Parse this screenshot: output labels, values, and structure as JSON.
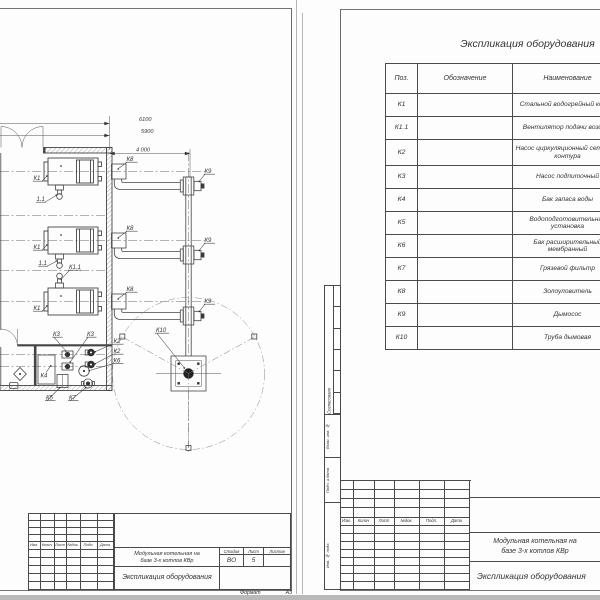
{
  "left_sheet": {
    "dimensions": {
      "top1": "6100",
      "top2": "5900",
      "right": "4 000"
    },
    "plan_labels": {
      "k1": "К1",
      "k1_1_short": "1.1",
      "k1_1": "К1.1",
      "k2": "К2",
      "k3": "К3",
      "k4": "К4",
      "k5": "К5",
      "k6": "К6",
      "k7": "К7",
      "k8": "К8",
      "k9": "К9",
      "k10": "К10"
    },
    "title_block": {
      "cols": [
        "Изм.",
        "Колич",
        "Лист",
        "№док.",
        "Подп.",
        "Дата"
      ],
      "project_line1": "Модульная котельная на",
      "project_line2": "базе 3-х котлов КВр",
      "doc_title": "Экспликация оборудования",
      "stage_label": "Стадия",
      "sheet_label": "Лист",
      "sheets_label": "Листов",
      "stage": "ВО",
      "sheet_num": "5",
      "format_label": "Формат",
      "format_value": "А3"
    }
  },
  "right_sheet": {
    "table_title": "Экспликация оборудования",
    "table": {
      "headers": {
        "pos": "Поз.",
        "designation": "Обозначение",
        "name": "Наименование"
      },
      "rows": [
        {
          "pos": "К1",
          "designation": "",
          "name": "Стальной водогрейный котел"
        },
        {
          "pos": "К1.1",
          "designation": "",
          "name": "Вентилятор подачи воздуха"
        },
        {
          "pos": "К2",
          "designation": "",
          "name": "Насос циркуляционный сетевого контура"
        },
        {
          "pos": "К3",
          "designation": "",
          "name": "Насос подпиточный"
        },
        {
          "pos": "К4",
          "designation": "",
          "name": "Бак запаса воды"
        },
        {
          "pos": "К5",
          "designation": "",
          "name": "Водоподготовительная установка"
        },
        {
          "pos": "К6",
          "designation": "",
          "name": "Бак расширительный мембранный"
        },
        {
          "pos": "К7",
          "designation": "",
          "name": "Грязевой фильтр"
        },
        {
          "pos": "К8",
          "designation": "",
          "name": "Золоуловитель"
        },
        {
          "pos": "К9",
          "designation": "",
          "name": "Дымосос"
        },
        {
          "pos": "К10",
          "designation": "",
          "name": "Труба дымовая"
        }
      ]
    },
    "side_strip": {
      "agreed": "Согласовано",
      "subst": "Взам. инв. №",
      "sign_date": "Подп. и дата",
      "inv": "Инв. № подл."
    },
    "title_block": {
      "cols": [
        "Изм.",
        "Колич",
        "Лист",
        "№док.",
        "Подп.",
        "Дата"
      ],
      "project_line1": "Модульная котельная на",
      "project_line2": "базе 3-х котлов КВр",
      "doc_title": "Экспликация оборудования"
    }
  }
}
